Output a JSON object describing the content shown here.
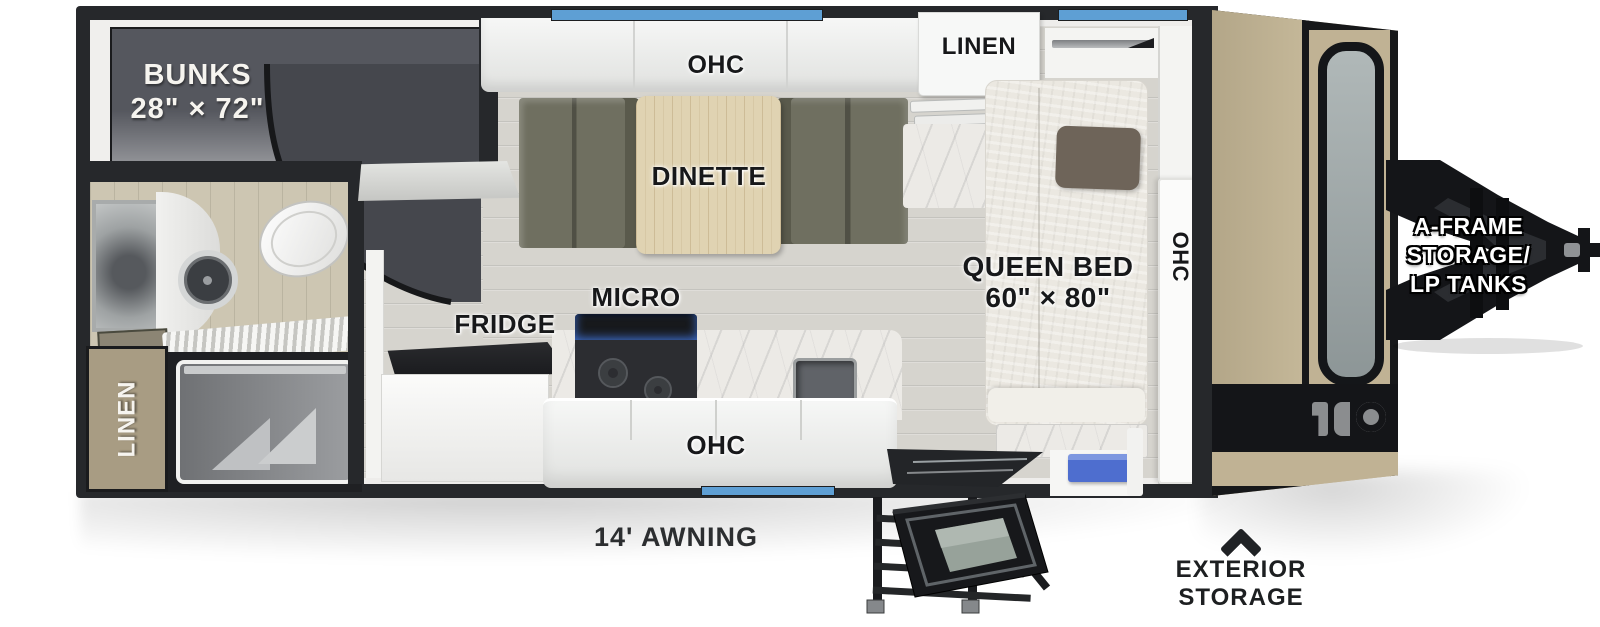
{
  "meta": {
    "figure": "travel-trailer-floorplan-top-view"
  },
  "labels": {
    "bunks_l1": "BUNKS",
    "bunks_l2": "28\" × 72\"",
    "ohc_top": "OHC",
    "linen_top": "LINEN",
    "dinette": "DINETTE",
    "queen_l1": "QUEEN BED",
    "queen_l2": "60\" × 80\"",
    "ohc_front": "OHC",
    "fridge": "FRIDGE",
    "micro": "MICRO",
    "ohc_bottom": "OHC",
    "linen_closet": "LINEN",
    "awning": "14' AWNING",
    "aframe_l1": "A-FRAME",
    "aframe_l2": "STORAGE/",
    "aframe_l3": "LP TANKS",
    "exterior_l1": "EXTERIOR",
    "exterior_l2": "STORAGE"
  },
  "colors": {
    "wall_black": "#26282b",
    "window_glass_blue": "#5e9fd4",
    "cap_tan": "#c0b294",
    "bench_olive": "#6f6f60",
    "entry_tray_blue": "#4e6ecf",
    "bunk_room_gray": "#55575e"
  }
}
